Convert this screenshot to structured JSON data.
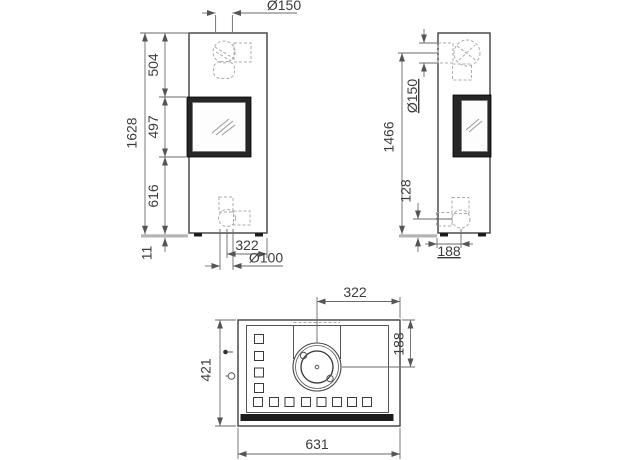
{
  "drawing": {
    "front_view": {
      "total_height": "1628",
      "top_to_door": "504",
      "door_height": "497",
      "door_to_floor": "616",
      "base_height": "11",
      "top_flue_diameter": "Ø150",
      "bottom_flue_offset": "322",
      "bottom_flue_diameter": "Ø100"
    },
    "side_view": {
      "rear_flue_center_height": "1466",
      "rear_flue_diameter": "Ø150",
      "bottom_flue_center_height": "128",
      "bottom_flue_center_depth": "188"
    },
    "top_view": {
      "depth": "421",
      "width": "631",
      "flue_center_to_right": "322",
      "flue_center_to_rear": "188"
    }
  }
}
